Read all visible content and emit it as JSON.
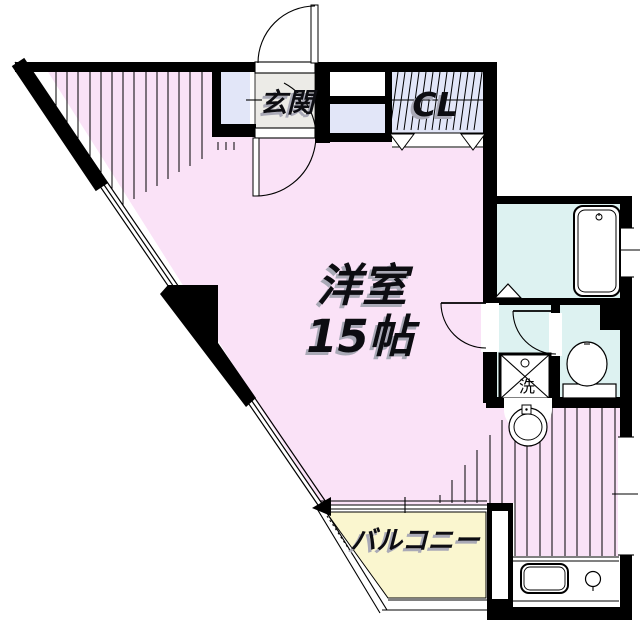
{
  "plan": {
    "rooms": {
      "main_room": {
        "name_label": "洋室",
        "size_label": "15帖"
      },
      "entrance_label": "玄関",
      "closet_label": "CL",
      "balcony_label": "バルコニー",
      "laundry_label": "洗"
    },
    "colors": {
      "room_pink": "#FAE2F7",
      "closet_lavender": "#E2E6F8",
      "entrance_gray": "#ECEBE7",
      "bath_cyan": "#DDF2F1",
      "balcony_yellow": "#FAF6CF",
      "wall_black": "#000000",
      "label_shadow_gray": "#A9A9B6"
    }
  }
}
